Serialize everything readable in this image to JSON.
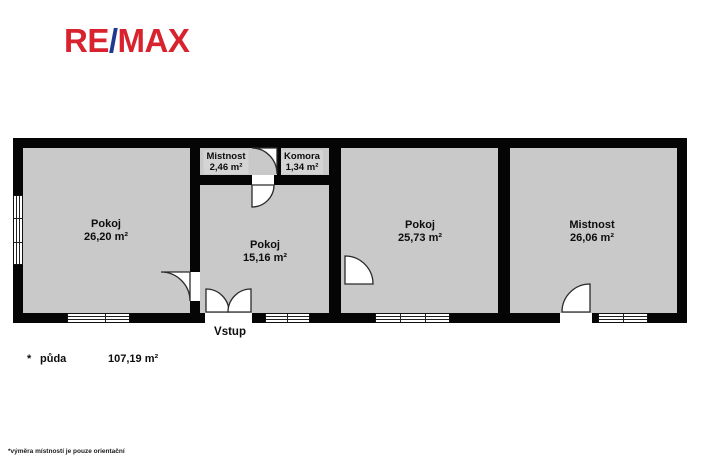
{
  "logo": {
    "re": "RE",
    "slash": "/",
    "max": "MAX",
    "red": "#d8232f",
    "blue": "#1d3a8f"
  },
  "rooms": [
    {
      "id": "room-1",
      "name": "Pokoj",
      "area": "26,20 m²"
    },
    {
      "id": "mistnost-small",
      "name": "Mistnost",
      "area": "2,46 m²"
    },
    {
      "id": "komora",
      "name": "Komora",
      "area": "1,34 m²"
    },
    {
      "id": "room-2",
      "name": "Pokoj",
      "area": "15,16 m²"
    },
    {
      "id": "room-3",
      "name": "Pokoj",
      "area": "25,73 m²"
    },
    {
      "id": "room-4",
      "name": "Mistnost",
      "area": "26,06 m²"
    }
  ],
  "entrance_label": "Vstup",
  "legend": {
    "marker": "*",
    "name": "půda",
    "area": "107,19 m²"
  },
  "footnote": "*výměra místností je pouze orientační",
  "colors": {
    "floor": "#c9c9c9",
    "wall": "#050505",
    "logo_red": "#d8232f",
    "logo_blue": "#1d3a8f"
  }
}
